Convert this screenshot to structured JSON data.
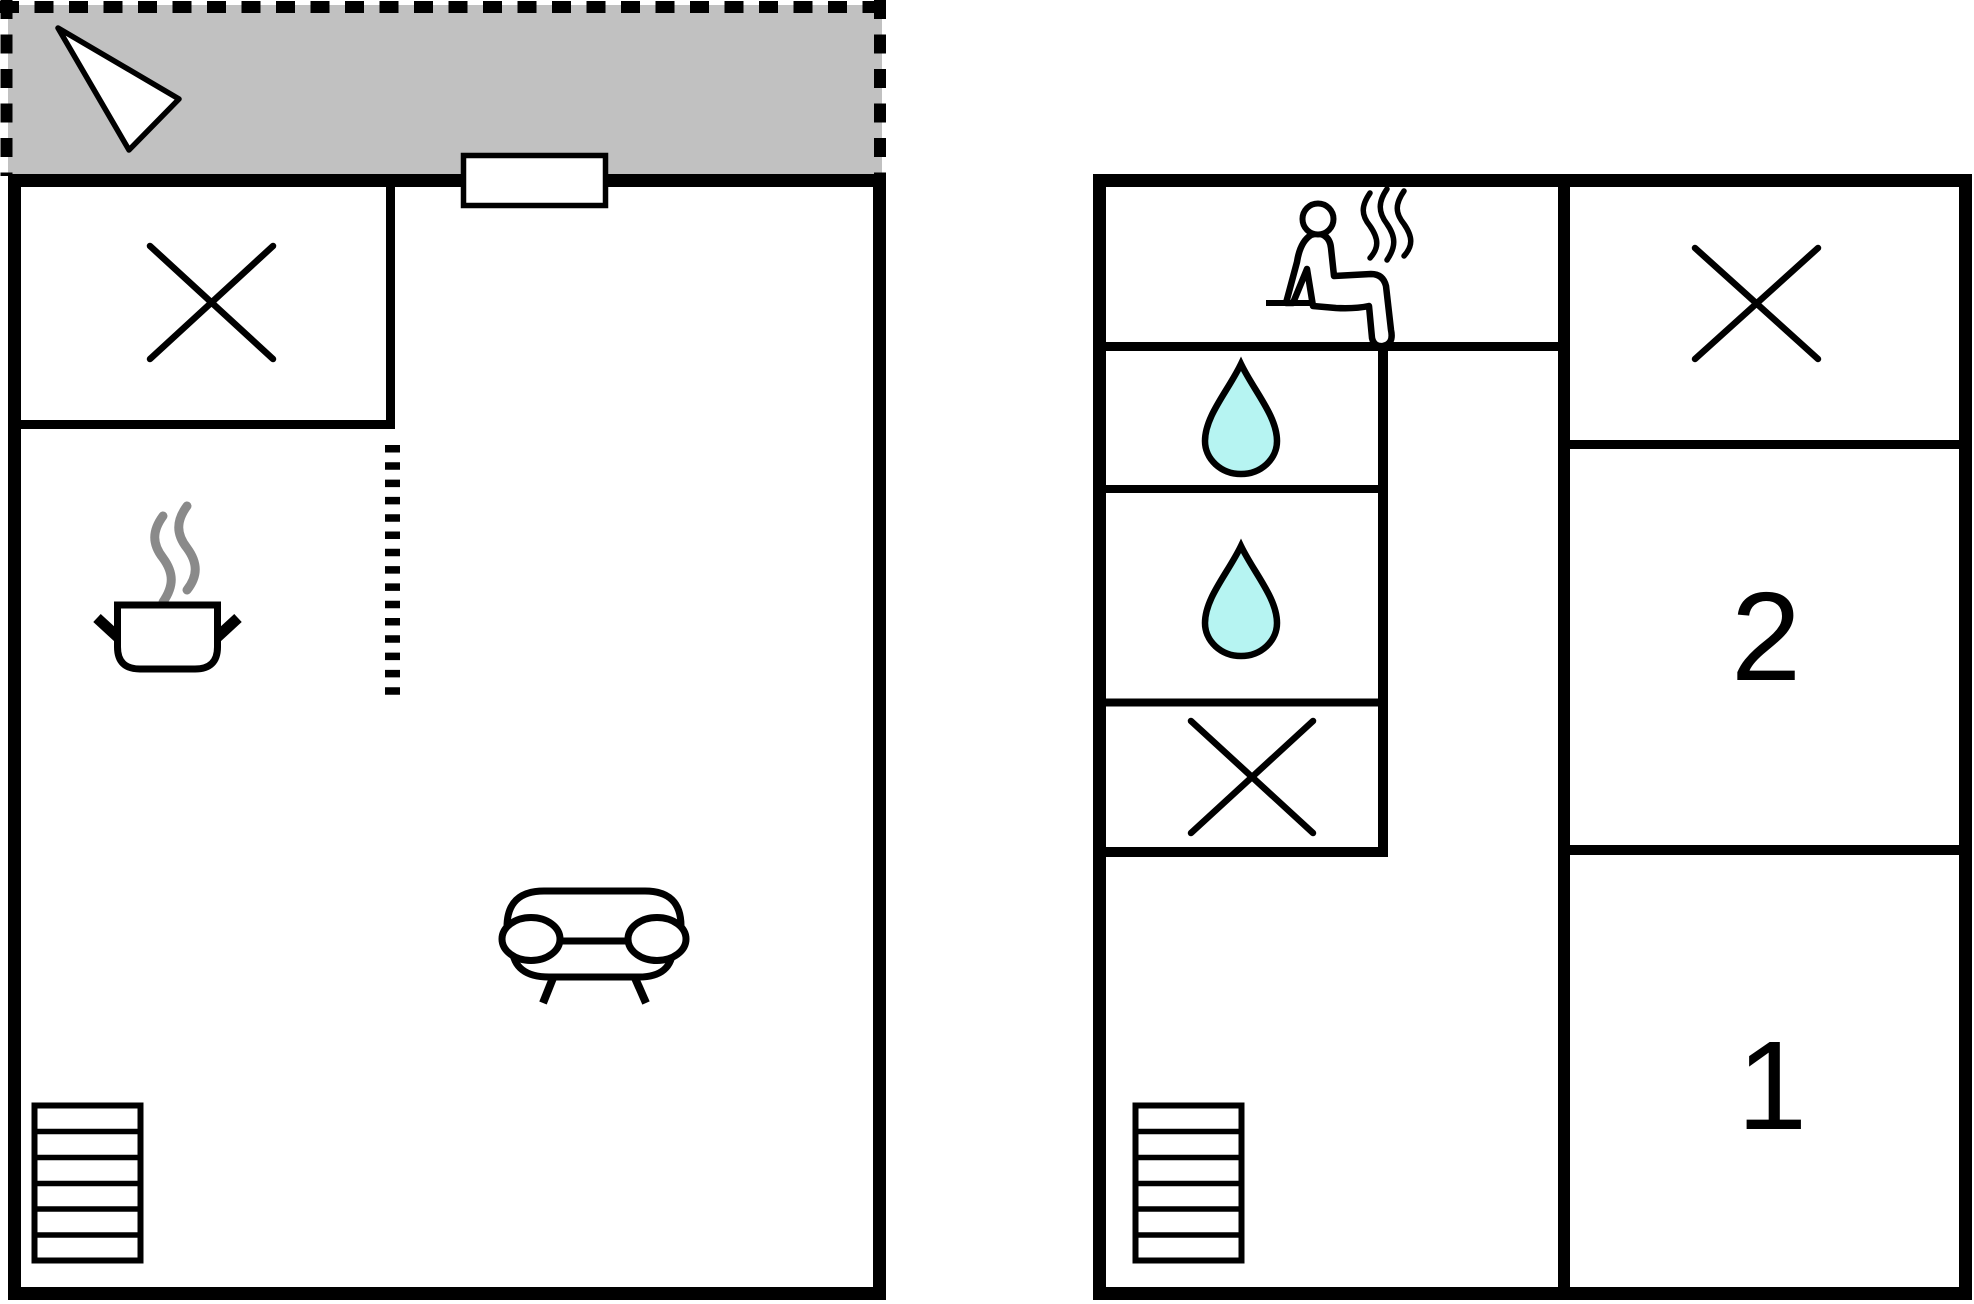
{
  "plans": {
    "ground": {
      "icons": [
        "north-arrow",
        "window",
        "crossed-area",
        "cooking-pot",
        "steam",
        "wall-opening-dashed",
        "sofa",
        "staircase"
      ]
    },
    "upper": {
      "icons": [
        "sauna-person",
        "steam",
        "shower-drop",
        "shower-drop",
        "crossed-area",
        "crossed-area",
        "staircase"
      ],
      "rooms": [
        {
          "label": "1"
        },
        {
          "label": "2"
        }
      ]
    }
  },
  "room_labels": {
    "room1": "1",
    "room2": "2"
  },
  "colors": {
    "wall": "#000000",
    "terrace_fill": "#c1c1c1",
    "drop_fill": "#b6f4f2",
    "steam_gray": "#8a8a8a",
    "background": "#ffffff"
  }
}
